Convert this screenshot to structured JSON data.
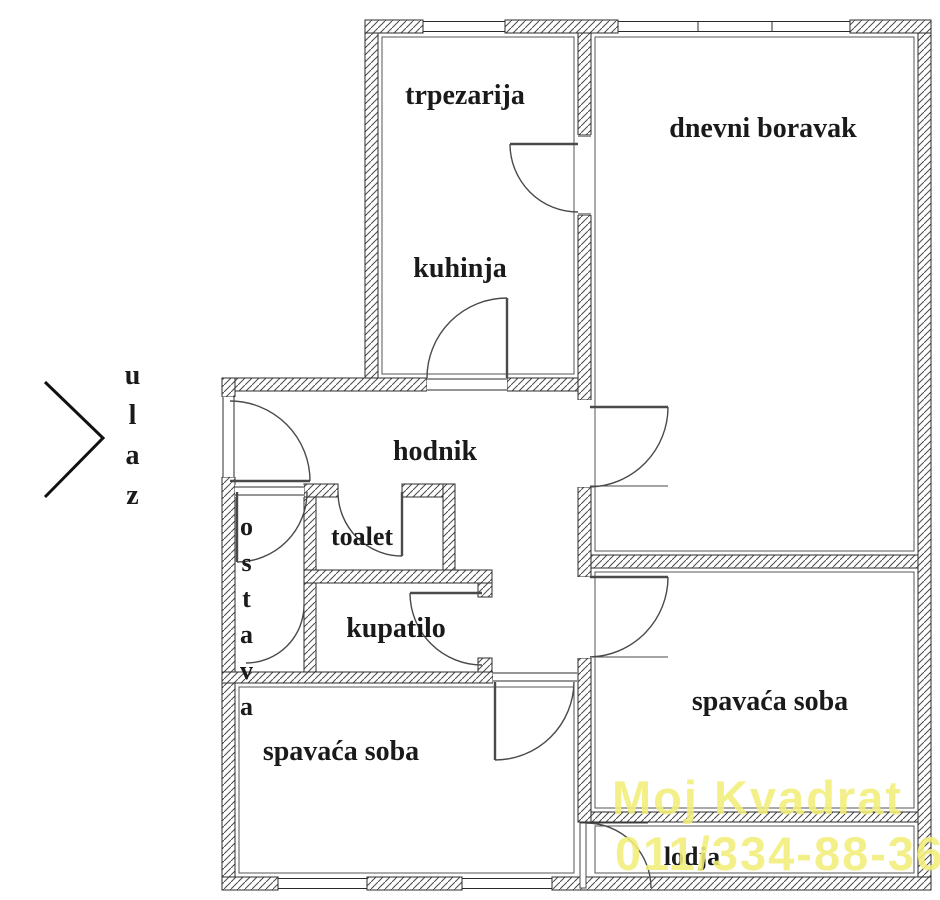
{
  "plan": {
    "title": "apartment floor plan",
    "rooms": {
      "trpezarija": "trpezarija",
      "dnevni_boravak": "dnevni boravak",
      "kuhinja": "kuhinja",
      "hodnik": "hodnik",
      "toalet": "toalet",
      "kupatilo": "kupatilo",
      "ostava": "ostava",
      "spavaca_soba_left": "spavaća soba",
      "spavaca_soba_right": "spavaća soba",
      "lodja": "lodja"
    },
    "entrance": {
      "label": "ulaz"
    },
    "watermark": {
      "line1": "Moj Kvadrat",
      "line2": "011/334-88-36",
      "color": "#f2ee7a"
    },
    "wall_color": "#3c3c3c",
    "door_color": "#4a4a4a"
  }
}
